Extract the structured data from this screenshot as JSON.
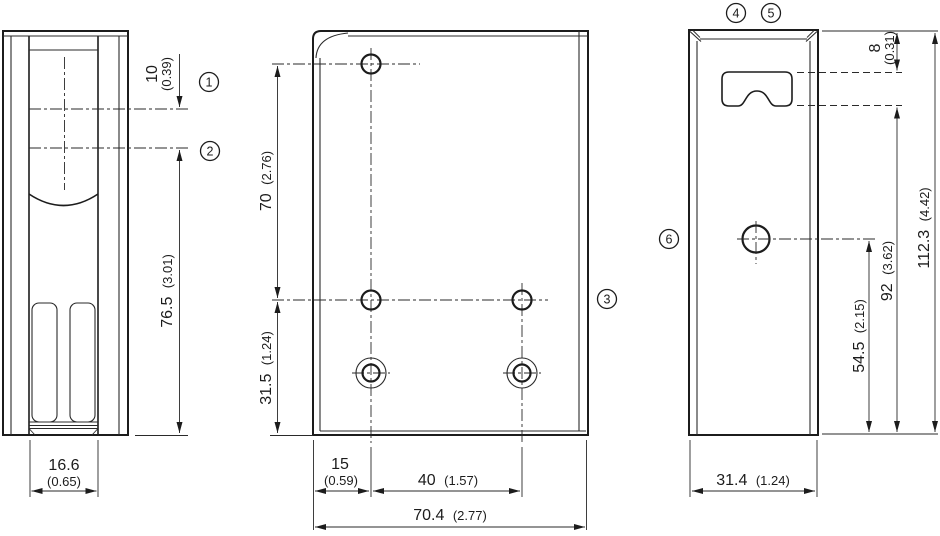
{
  "drawing_title": "Mounting bracket dimensional drawing, three orthographic views",
  "views": {
    "side": {
      "offset_mm": "10",
      "offset_in": "(0.39)",
      "height_mm": "76.5",
      "height_in": "(3.01)",
      "width_mm": "16.6",
      "width_in": "(0.65)"
    },
    "front": {
      "hole_spacing_v_mm": "70",
      "hole_spacing_v_in": "(2.76)",
      "hole_bottom_mm": "31.5",
      "hole_bottom_in": "(1.24)",
      "hole_left_mm": "15",
      "hole_left_in": "(0.59)",
      "hole_spacing_h_mm": "40",
      "hole_spacing_h_in": "(1.57)",
      "width_mm": "70.4",
      "width_in": "(2.77)"
    },
    "profile": {
      "slot_top_mm": "8",
      "slot_top_in": "(0.31)",
      "height_mm": "112.3",
      "height_in": "(4.42)",
      "slot_bottom_mm": "92",
      "slot_bottom_in": "(3.62)",
      "hole_bottom_mm": "54.5",
      "hole_bottom_in": "(2.15)",
      "width_mm": "31.4",
      "width_in": "(1.24)"
    }
  },
  "callouts": {
    "c1": "1",
    "c2": "2",
    "c3": "3",
    "c4": "4",
    "c5": "5",
    "c6": "6"
  }
}
